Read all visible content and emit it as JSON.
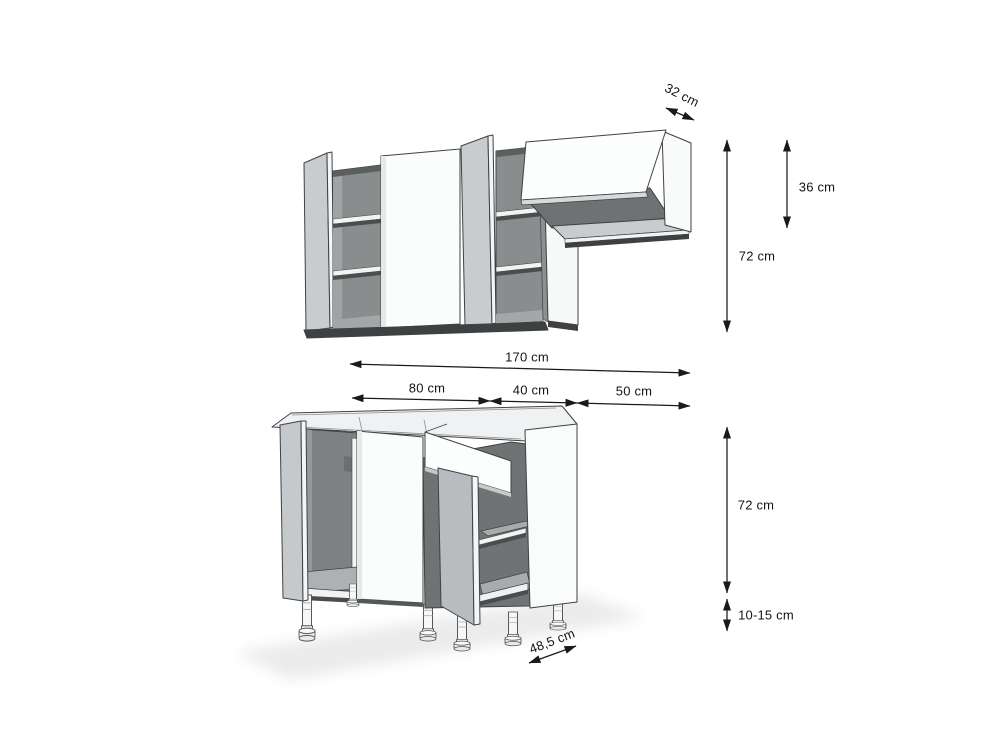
{
  "drawing": {
    "kind": "kitchen-cabinet-dimension-diagram",
    "dimensions": {
      "upper_depth": "32 cm",
      "flap_cabinet_height": "36 cm",
      "upper_cabinet_height": "72 cm",
      "total_width": "170 cm",
      "segment_widths": [
        "80 cm",
        "40 cm",
        "50 cm"
      ],
      "base_cabinet_height": "72 cm",
      "leg_height_range": "10-15 cm",
      "base_depth": "48,5 cm"
    },
    "colors": {
      "background": "#ffffff",
      "outline": "#3f4244",
      "panel_white": "#fbfcfc",
      "door_gray": "#c6c9cb",
      "interior_dark": "#7e8182",
      "shelf_light": "#a8abac",
      "underside_dark": "#3e4041",
      "dimension_line": "#1a1a1a"
    }
  }
}
